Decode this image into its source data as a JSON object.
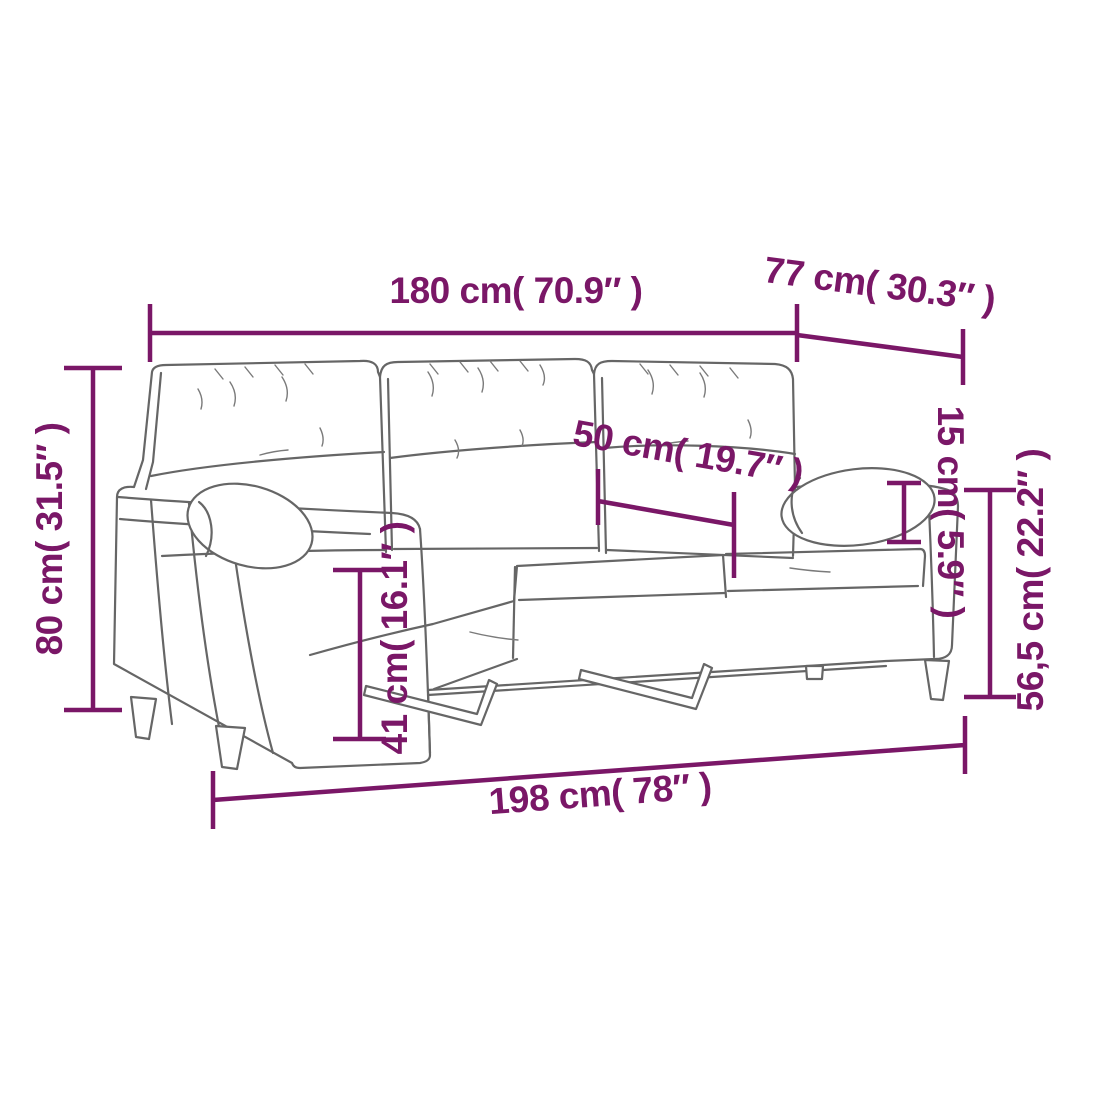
{
  "page": {
    "background": "#ffffff"
  },
  "diagram": {
    "subject": "3-seater sofa with bolster pillows - dimension diagram",
    "accent_color": "#7a1767",
    "sketch_color": "#666666",
    "labels": {
      "total_width": "180 cm( 70.9″ )",
      "depth": "77 cm( 30.3″ )",
      "back_height": "80 cm( 31.5″ )",
      "seat_cushion_width": "50 cm( 19.7″ )",
      "bolster_pillow_height": "15 cm( 5.9″ )",
      "arm_height": "56,5 cm( 22.2″ )",
      "seat_height": "41 cm( 16.1″ )",
      "total_length": "198 cm( 78″ )"
    }
  }
}
